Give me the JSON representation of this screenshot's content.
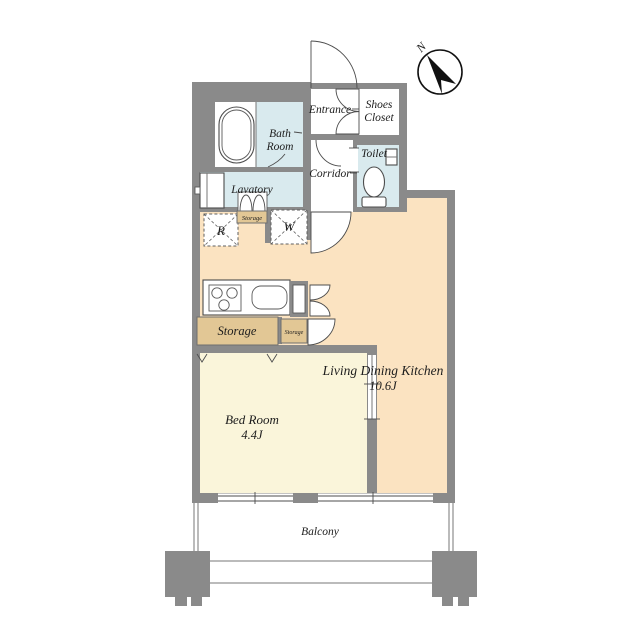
{
  "floor_plan": {
    "compass": {
      "north_label": "N"
    },
    "rooms": {
      "entrance": {
        "label": "Entrance"
      },
      "shoes_closet": {
        "line1": "Shoes",
        "line2": "Closet"
      },
      "bath_room": {
        "line1": "Bath",
        "line2": "Room"
      },
      "lavatory": {
        "label": "Lavatory"
      },
      "toilet": {
        "label": "Toilet"
      },
      "corridor": {
        "label": "Corridor"
      },
      "living_dining_kitchen": {
        "label": "Living Dining Kitchen",
        "size": "10.6J"
      },
      "bed_room": {
        "label": "Bed Room",
        "size": "4.4J"
      },
      "balcony": {
        "label": "Balcony"
      }
    },
    "storage": {
      "laundry_wall": "Storage",
      "kitchen_large": "Storage",
      "kitchen_small": "Storage"
    },
    "appliance_spaces": {
      "refrigerator": "R",
      "washer": "W"
    },
    "colors": {
      "wall": "#8a8a8a",
      "wet_area": "#d9eaee",
      "ldk_floor": "#fbe3c1",
      "bedroom_floor": "#faf5da",
      "storage_fill": "#e2c globals",
      "storage_tan": "#e2c795",
      "white": "#ffffff",
      "outline": "#4c4c4c"
    }
  }
}
